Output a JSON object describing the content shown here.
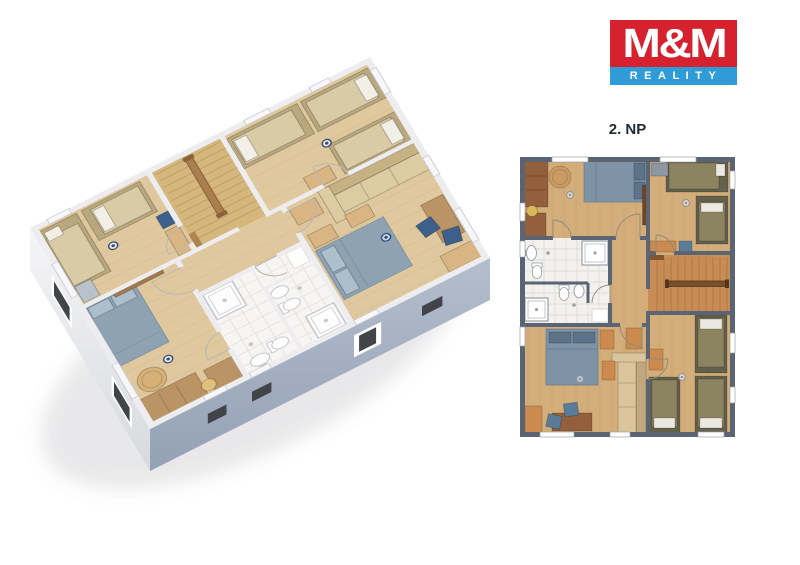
{
  "logo": {
    "brand": "M&M",
    "tagline": "REALITY"
  },
  "plan": {
    "title": "2. NP",
    "depicted": {
      "left_view": "3d-isometric-dollhouse-render-of-floor",
      "right_view": "2d-floor-plan",
      "rooms_shown": [
        "bedroom-top-left",
        "bedroom-top-right",
        "staircase",
        "hallway",
        "two-bathrooms",
        "bedroom-bottom-left",
        "bedroom-bottom-right"
      ]
    }
  },
  "colors": {
    "brand": {
      "red": "#d6222e",
      "blue": "#2f9cd8",
      "text": "#ffffff"
    },
    "title": {
      "text": "#1f2a35"
    },
    "p2": {
      "wall": "#5a6472",
      "floor": "#d4ae7a",
      "grain": "#a8804e",
      "stairs": "#c78d55",
      "stairline": "#8a5e34",
      "rail": "#7a4f2a",
      "raildark": "#53351c",
      "bath": "#f2f1ee",
      "bathgrid": "#d9d6d1",
      "bedblue": "#7e93a6",
      "bedblued": "#64798c",
      "pillowblue": "#5d7389",
      "olive": "#8c8361",
      "oliveframe": "#63604b",
      "pillow": "#eae8e0",
      "orange": "#cd8a4f",
      "brown": "#935f3d",
      "browndark": "#6f4526",
      "beige": "#d9c49c",
      "beiged": "#bfa87e",
      "table": "#c99b62",
      "stool": "#d8b959",
      "bluechair": "#5a7c99",
      "greyblue": "#8b97a3",
      "dot": "#8d949e",
      "win": "#ffffff",
      "winframe": "#9aa0a8",
      "arc": "#8a8a80",
      "fixture": "#ffffff",
      "fixframe": "#9aa0a8"
    },
    "p3": {
      "wall": "#ededf0",
      "floor": "#e0c89e",
      "grain": "#c2a06c",
      "stairs": "#d5b67c",
      "stairline": "#a98a54",
      "rail": "#a97f4e",
      "raildark": "#8a6238",
      "bath": "#f6f5f3",
      "bathgrid": "#e4e2dd",
      "bedblue": "#8fa2b2",
      "bedblued": "#7a8fa0",
      "pillowblue": "#aebfcc",
      "olive": "#d8cba6",
      "oliveframe": "#b9a87e",
      "pillow": "#f2efe7",
      "orange": "#d9b583",
      "brown": "#bb9466",
      "browndark": "#a07a4e",
      "beige": "#ddcba2",
      "beiged": "#c6b184",
      "table": "#d6b077",
      "stool": "#dfc17e",
      "bluechair": "#3c5f8c",
      "greyblue": "#b9c2cb",
      "dot": "#2e4f7e",
      "win": "#f7f7f9",
      "winframe": "#c9ccd2",
      "arc": "#b9b9b2",
      "fixture": "#fdfdfd",
      "fixframe": "#c5c8cd"
    },
    "ext": {
      "facewhite1": "#f5f5f7",
      "facewhite2": "#d7d9dd",
      "faceblue1": "#b3becd",
      "faceblue2": "#94a1b5",
      "slot": "#41454a",
      "frame": "#ffffff",
      "shadow": "rgba(110,115,125,0.16)"
    }
  }
}
